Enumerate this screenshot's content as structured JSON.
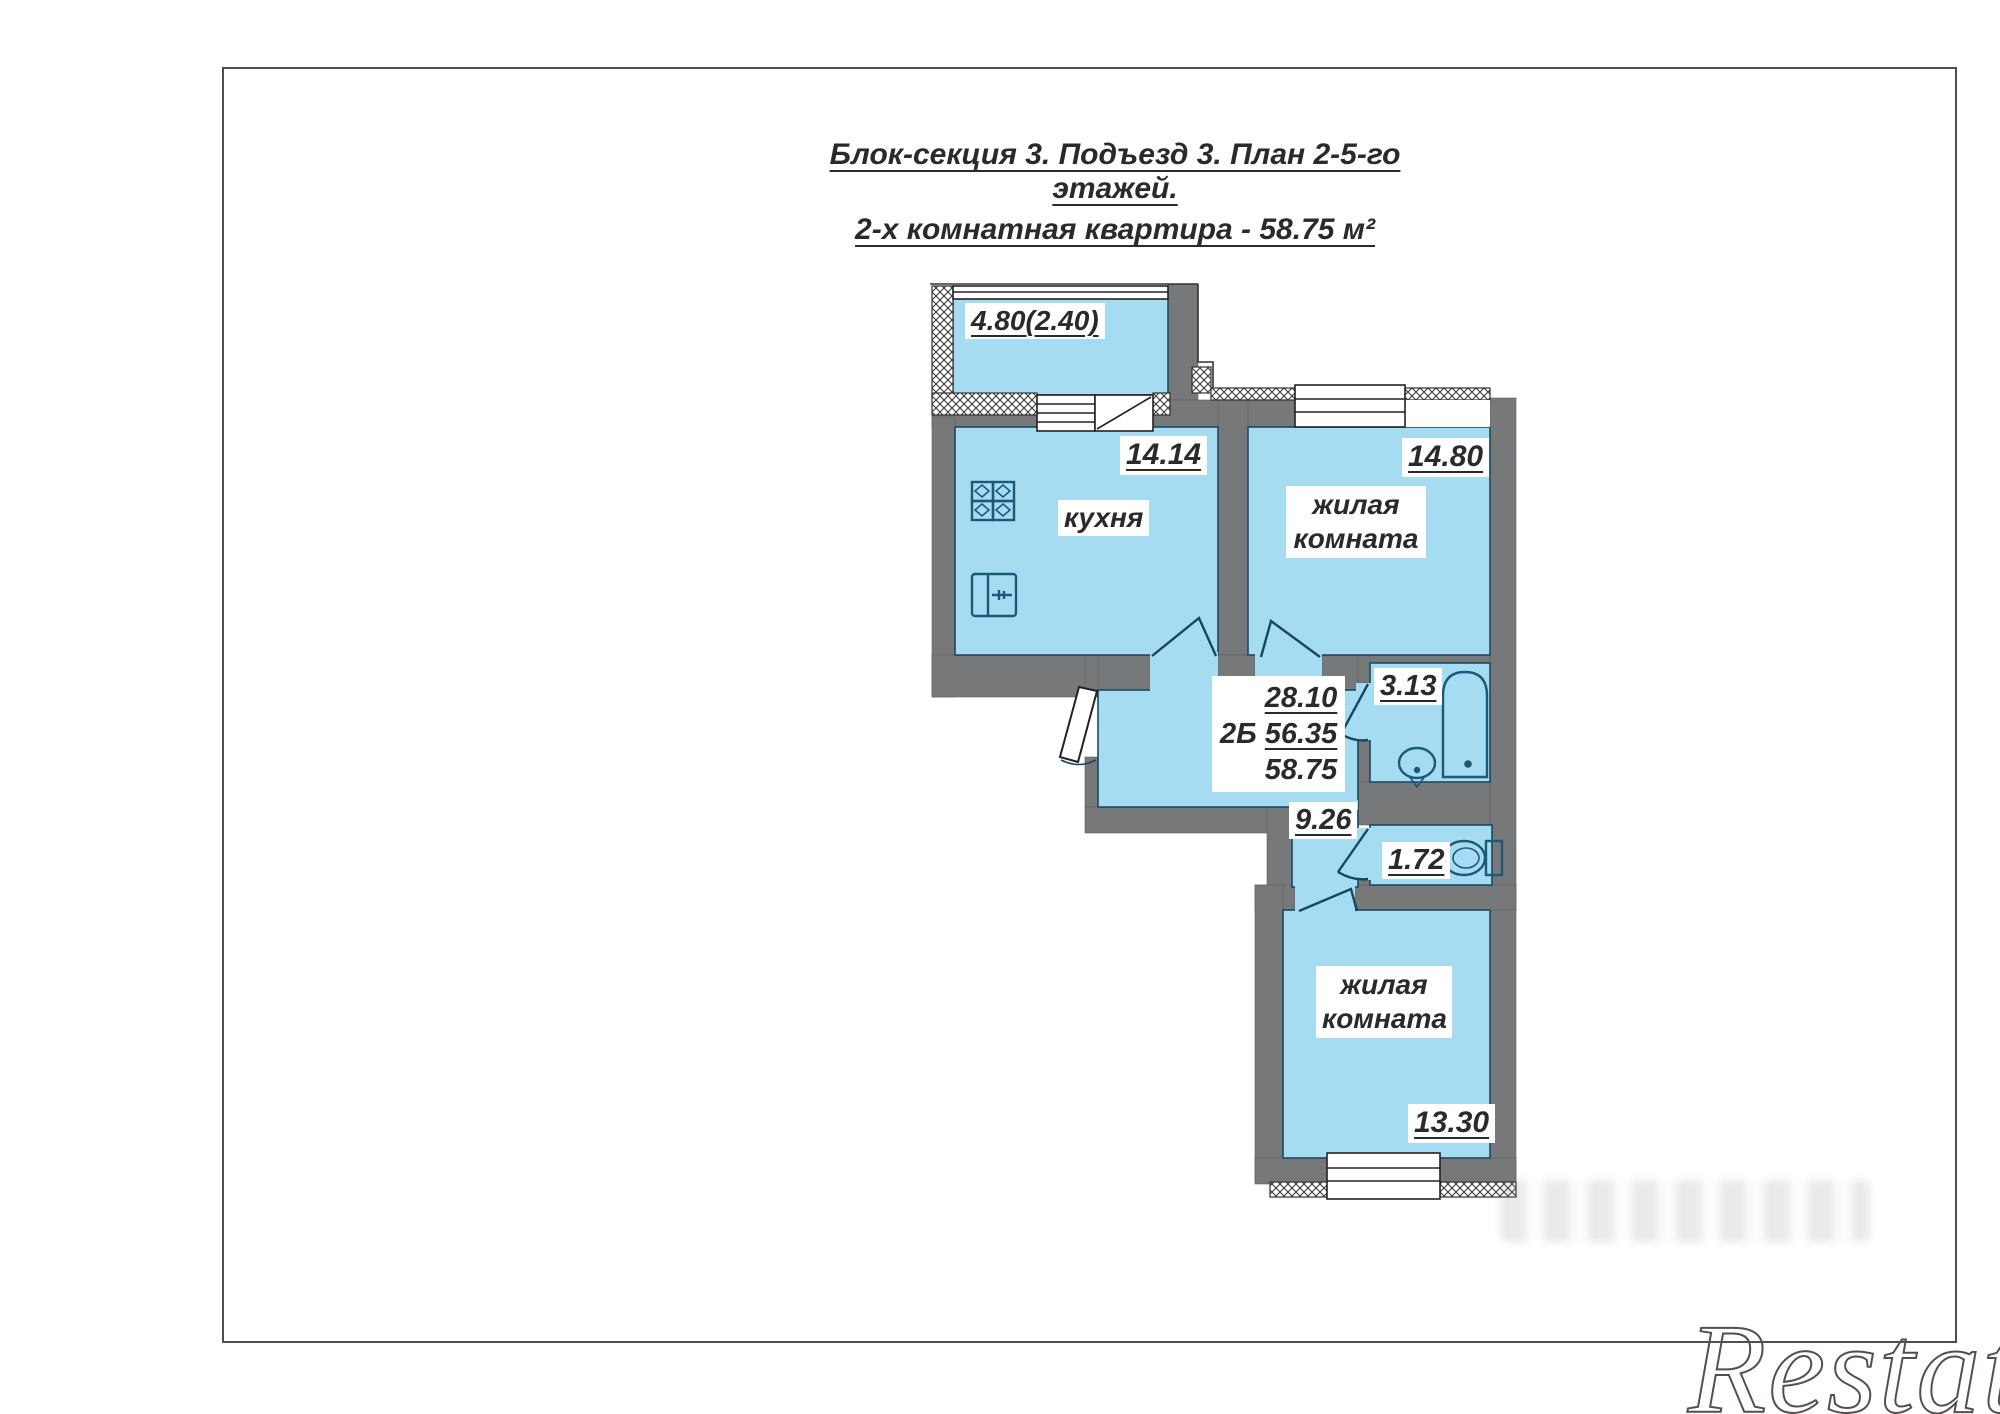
{
  "title": {
    "line1": "Блок-секция 3. Подъезд 3. План 2-5-го этажей.",
    "line2": "2-х комнатная квартира - 58.75 м²"
  },
  "plan": {
    "balcony": {
      "area": "4.80(2.40)"
    },
    "kitchen": {
      "name": "кухня",
      "area": "14.14"
    },
    "living1": {
      "name": "жилая комната",
      "area": "14.80"
    },
    "hall": {
      "type": "2Б",
      "area_living": "28.10",
      "area_main": "56.35",
      "area_total": "58.75"
    },
    "bath": {
      "area": "3.13"
    },
    "hall2": {
      "area": "9.26"
    },
    "wc": {
      "area": "1.72"
    },
    "living2": {
      "name": "жилая комната",
      "area": "13.30"
    }
  },
  "icons": {
    "stove": "stove-icon",
    "kitchen_sink": "sink-icon",
    "bathtub": "bathtub-icon",
    "washbasin": "washbasin-icon",
    "toilet": "toilet-icon"
  },
  "watermark": {
    "text": "Restate"
  },
  "colors": {
    "wall_gray": "#77787a",
    "room_blue": "#a5dcf2",
    "outline_dark": "#1c4a5e",
    "fixture_stroke": "#1d5878",
    "text_color": "#2a2a2a",
    "page_border": "#4e4e4e",
    "watermark_gray": "#564e4e"
  }
}
